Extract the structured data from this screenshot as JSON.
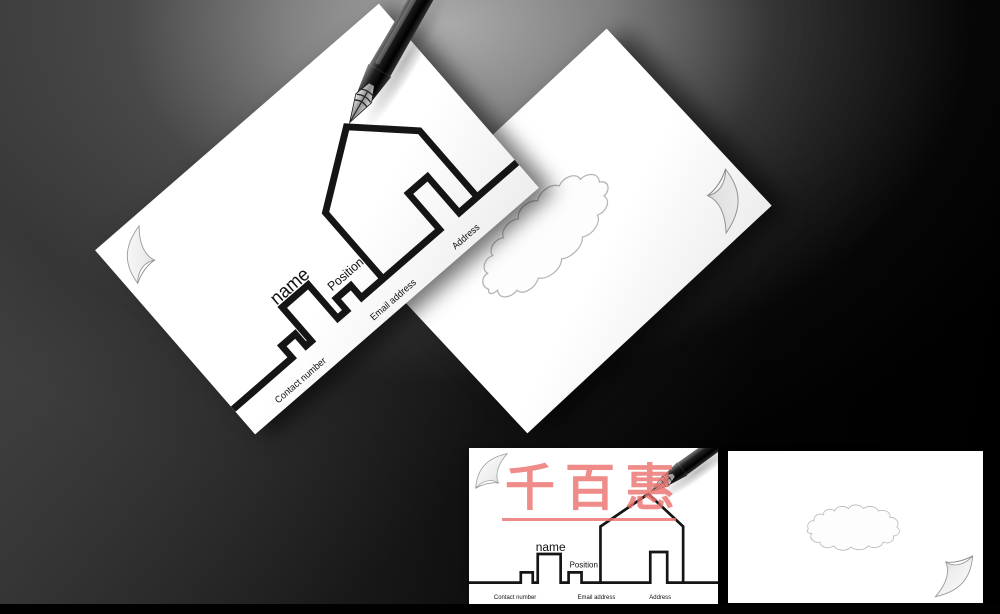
{
  "front_card": {
    "name_label": "name",
    "position_label": "Position",
    "contact_label": "Contact number",
    "email_label": "Email address",
    "address_label": "Address",
    "line_color": "#151515",
    "paper_color": "#ffffff"
  },
  "back_card": {
    "paper_color": "#ffffff"
  },
  "watermark": {
    "text": "千百惠",
    "color": "#ec7370"
  },
  "background": {
    "base_color": "#000000",
    "highlight_color": "#b0b0b0",
    "bottom_bar_color": "#010101"
  },
  "icons": {
    "pen": "fountain-pen",
    "curl": "page-curl",
    "blot": "ink-blot-outline"
  }
}
